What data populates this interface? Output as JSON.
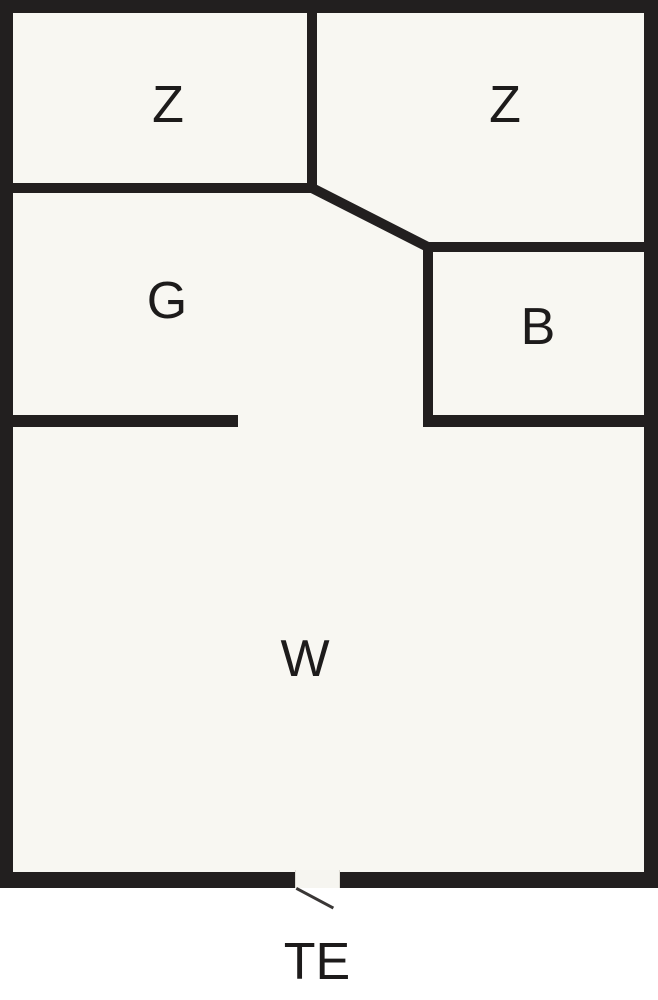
{
  "plan": {
    "type": "floor-plan",
    "rooms": [
      {
        "id": "z1",
        "label": "Z"
      },
      {
        "id": "z2",
        "label": "Z"
      },
      {
        "id": "g",
        "label": "G"
      },
      {
        "id": "b",
        "label": "B"
      },
      {
        "id": "w",
        "label": "W"
      }
    ],
    "entrance_label": "TE"
  },
  "colors": {
    "wall": "#221f1f",
    "floor": "#f8f7f2",
    "page_background": "#ffffff",
    "label_text": "#1d1b1b",
    "door_line": "#3a3736"
  }
}
